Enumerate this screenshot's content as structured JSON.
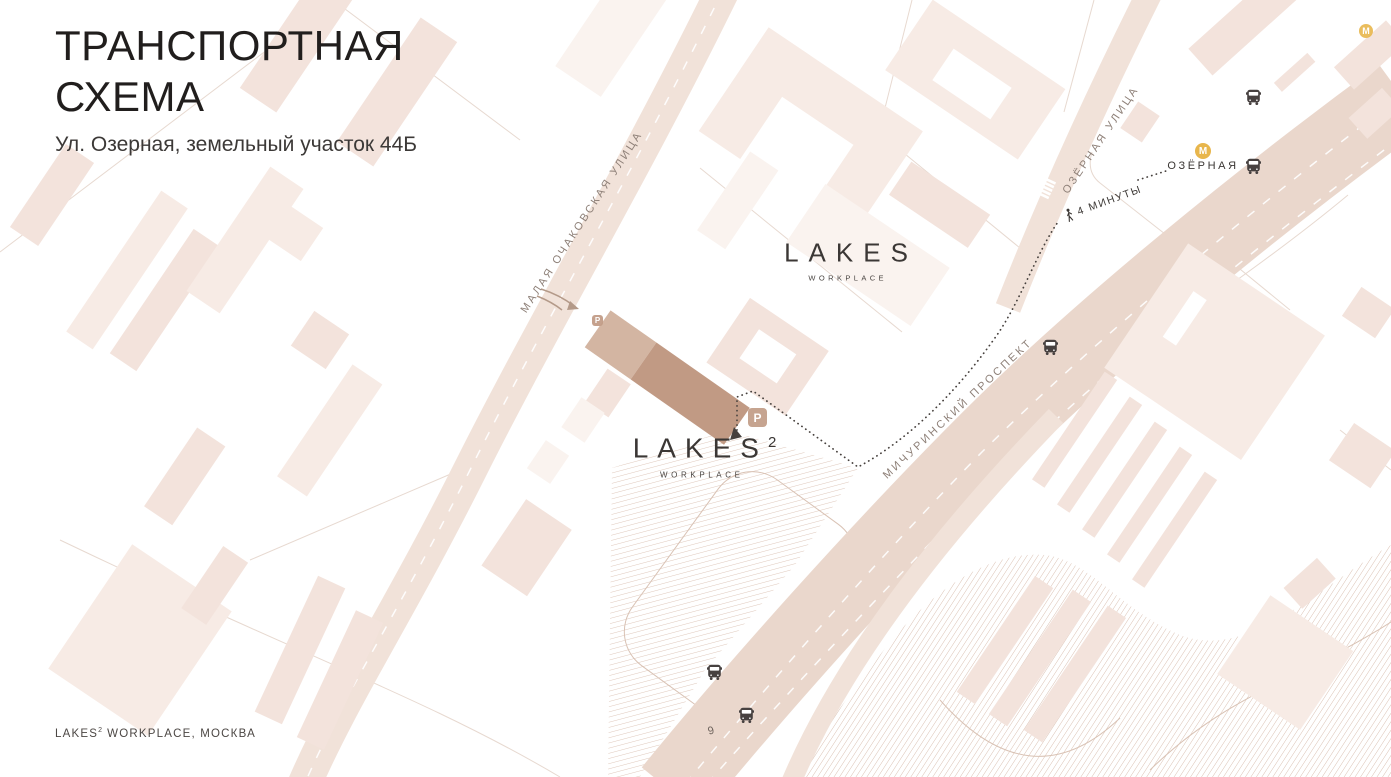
{
  "header": {
    "title_line1": "ТРАНСПОРТНАЯ",
    "title_line2": "СХЕМА",
    "subtitle": "Ул. Озерная, земельный участок 44Б"
  },
  "footer": {
    "brand": "LAKES",
    "sup": "2",
    "rest": "WORKPLACE, МОСКВА"
  },
  "map": {
    "streets": {
      "malaya_ochakovskaya": "МАЛАЯ ОЧАКОВСКАЯ УЛИЦА",
      "ozernaya_ulitsa": "ОЗЁРНАЯ УЛИЦА",
      "michurinsky": "МИЧУРИНСКИЙ ПРОСПЕКТ"
    },
    "route": {
      "walk_time": "4 МИНУТЫ"
    },
    "metro": {
      "station": "ОЗЁРНАЯ",
      "letter": "М"
    },
    "parking_letter": "P",
    "house_number": "9",
    "logo_lakes": {
      "name": "LAKES",
      "sub": "WORKPLACE"
    },
    "logo_lakes2": {
      "name": "LAKES",
      "sup": "2",
      "sub": "WORKPLACE"
    },
    "colors": {
      "metro-yellow": "#e8b64c",
      "accent-building": "#c19a84",
      "accent-building-light": "#d3b5a2",
      "street-fill": "#ead7cc",
      "street-fill-light": "#f1e2d9",
      "building-fill": "#f7ebe5",
      "building-fill-alt": "#f3e3dc",
      "building-fill-pale": "#faf3ef",
      "hatch-line": "#d8bdae",
      "label-muted": "#8e8078",
      "ink": "#46403d",
      "badge": "#c29d87"
    }
  }
}
